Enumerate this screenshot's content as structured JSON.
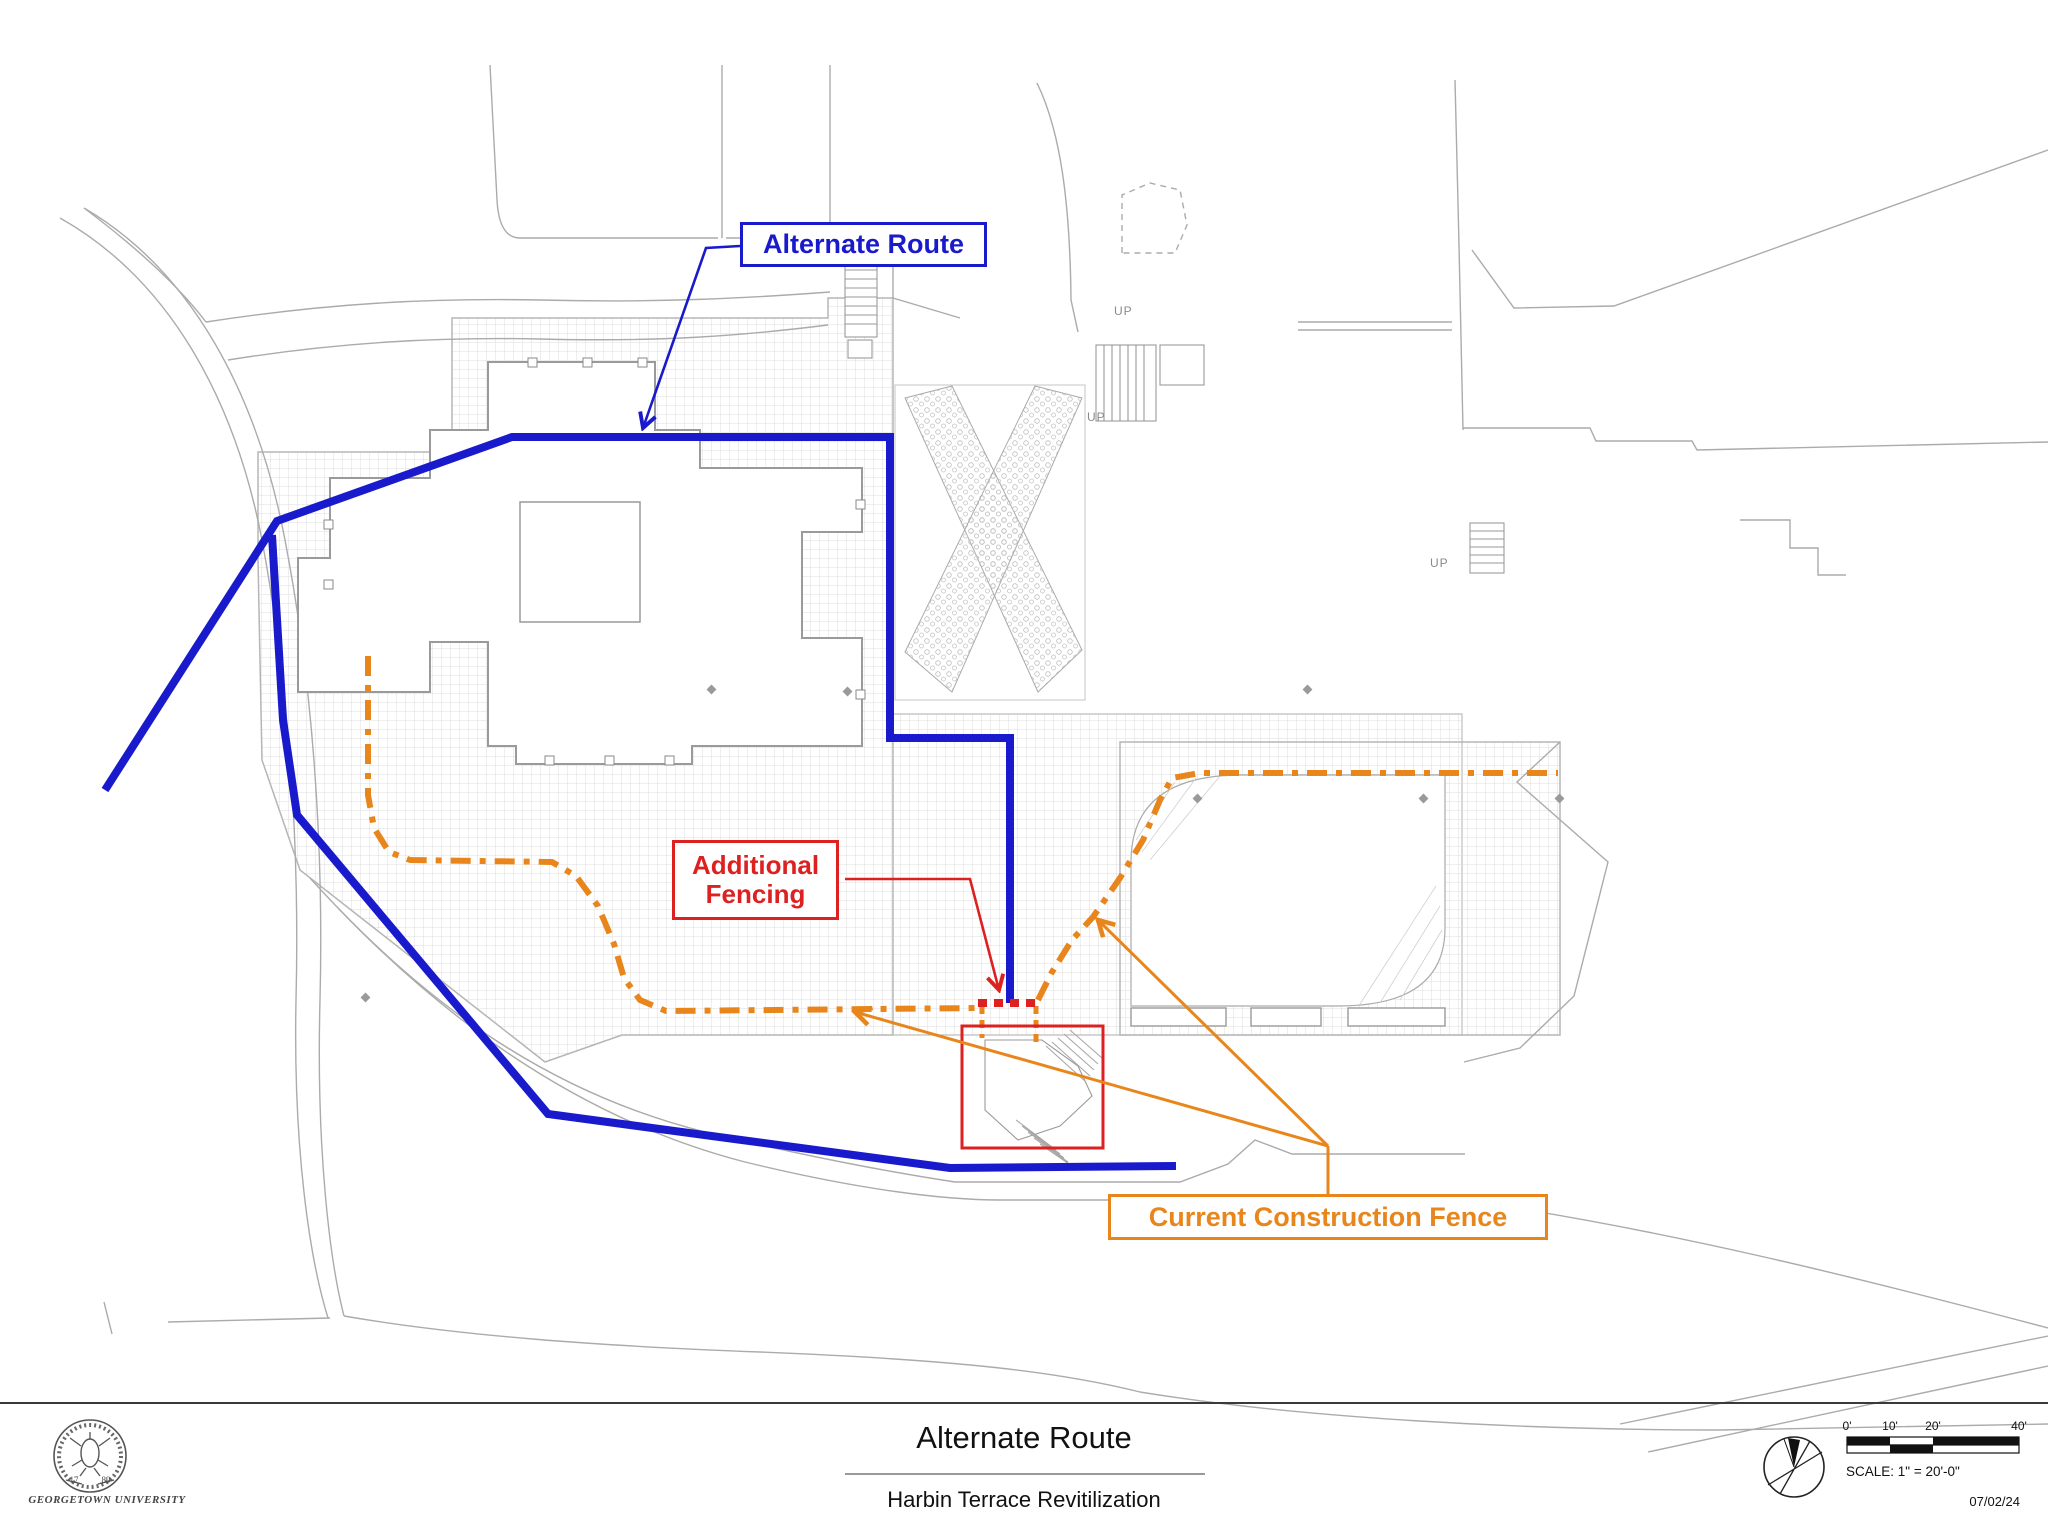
{
  "titleblock": {
    "title": "Alternate Route",
    "subtitle": "Harbin Terrace Revitilization",
    "org": "GEORGETOWN UNIVERSITY",
    "seal_year_left": "17",
    "seal_year_right": "89",
    "scale_label": "SCALE: 1\" = 20'-0\"",
    "scale_ticks": [
      "0'",
      "10'",
      "20'",
      "40'"
    ],
    "date": "07/02/24"
  },
  "callouts": {
    "alternate_route": "Alternate Route",
    "additional_fencing": "Additional Fencing",
    "current_construction_fence": "Current Construction Fence"
  },
  "plan": {
    "up_label": "UP"
  },
  "overlay": {
    "colors": {
      "route": "#1A1ACD",
      "fence": "#E8861C",
      "highlight": "#DD2020"
    },
    "route_main": [
      [
        105,
        790
      ],
      [
        277,
        521
      ],
      [
        512,
        437
      ],
      [
        890,
        437
      ],
      [
        890,
        738
      ],
      [
        1010,
        738
      ],
      [
        1010,
        1003
      ]
    ],
    "route_branch": [
      [
        272,
        535
      ],
      [
        283,
        720
      ],
      [
        297,
        815
      ],
      [
        548,
        1114
      ],
      [
        950,
        1168
      ],
      [
        1176,
        1166
      ]
    ],
    "fence_left": [
      [
        368,
        656
      ],
      [
        368,
        795
      ],
      [
        374,
        828
      ],
      [
        389,
        852
      ],
      [
        410,
        860
      ],
      [
        552,
        862
      ],
      [
        576,
        876
      ],
      [
        598,
        906
      ],
      [
        614,
        944
      ],
      [
        624,
        978
      ],
      [
        640,
        1000
      ],
      [
        666,
        1011
      ],
      [
        980,
        1008
      ]
    ],
    "fence_right": [
      [
        1038,
        1000
      ],
      [
        1052,
        972
      ],
      [
        1072,
        940
      ],
      [
        1093,
        917
      ],
      [
        1120,
        878
      ],
      [
        1143,
        840
      ],
      [
        1160,
        800
      ],
      [
        1172,
        778
      ],
      [
        1200,
        773
      ],
      [
        1558,
        773
      ]
    ],
    "fence_stub_left": [
      [
        982,
        1006
      ],
      [
        982,
        1038
      ]
    ],
    "fence_stub_right": [
      [
        1036,
        1006
      ],
      [
        1036,
        1048
      ]
    ],
    "added_fence_segment": [
      [
        978,
        1003
      ],
      [
        1040,
        1003
      ]
    ],
    "highlight_rect": {
      "x": 962,
      "y": 1026,
      "w": 141,
      "h": 122
    },
    "leader_blue": [
      [
        740,
        246
      ],
      [
        706,
        248
      ],
      [
        643,
        428
      ]
    ],
    "leader_red": [
      [
        845,
        879
      ],
      [
        970,
        879
      ],
      [
        999,
        990
      ]
    ],
    "leader_orange_stem": [
      [
        1328,
        1194
      ],
      [
        1328,
        1146
      ]
    ],
    "leader_orange_a": [
      [
        1328,
        1146
      ],
      [
        1098,
        920
      ]
    ],
    "leader_orange_b": [
      [
        1328,
        1146
      ],
      [
        855,
        1012
      ]
    ]
  }
}
